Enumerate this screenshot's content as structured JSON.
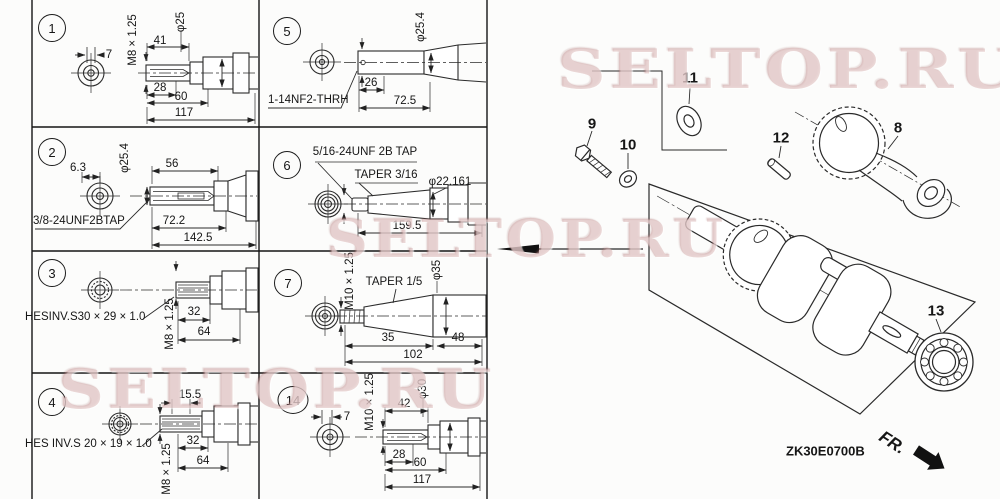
{
  "watermark": {
    "text": "SELTOP.RU",
    "color": "#c58c8c"
  },
  "cells": {
    "c1": {
      "num": "1",
      "tick": "7",
      "thread": "M8 × 1.25",
      "len1": "41",
      "dia": "φ25",
      "len2": "28",
      "len3": "60",
      "len4": "117"
    },
    "c5": {
      "num": "5",
      "dia": "φ25.4",
      "len1": "26",
      "len2": "72.5",
      "thread": "1-14NF2-THRH"
    },
    "c2": {
      "num": "2",
      "tick": "6.3",
      "dia": "φ25.4",
      "len1": "56",
      "thread": "3/8-24UNF2BTAP",
      "len2": "72.2",
      "len3": "142.5"
    },
    "c6": {
      "num": "6",
      "tap": "5/16-24UNF 2B TAP",
      "taper": "TAPER 3/16",
      "dia": "φ22.161",
      "len1": "159.5"
    },
    "c3": {
      "num": "3",
      "spline": "HESINV.S30 × 29 × 1.0",
      "thread": "M8 × 1.25",
      "len1": "32",
      "len2": "64"
    },
    "c7": {
      "num": "7",
      "thread": "M10 × 1.25",
      "taper": "TAPER 1/5",
      "dia": "φ35",
      "len1": "35",
      "len2": "48",
      "len3": "102"
    },
    "c4": {
      "num": "4",
      "len0": "15.5",
      "spline": "HES INV.S 20 × 19 × 1.0",
      "thread": "M8 × 1.25",
      "len1": "32",
      "len2": "64"
    },
    "c14": {
      "num": "14",
      "tick": "7",
      "thread": "M10 × 1.25",
      "len1": "42",
      "dia": "φ30",
      "len2": "28",
      "len3": "60",
      "len4": "117"
    }
  },
  "parts": {
    "p8": "8",
    "p9": "9",
    "p10": "10",
    "p11": "11",
    "p12": "12",
    "p13": "13"
  },
  "footer": {
    "code": "ZK30E0700B",
    "direction": "FR."
  }
}
